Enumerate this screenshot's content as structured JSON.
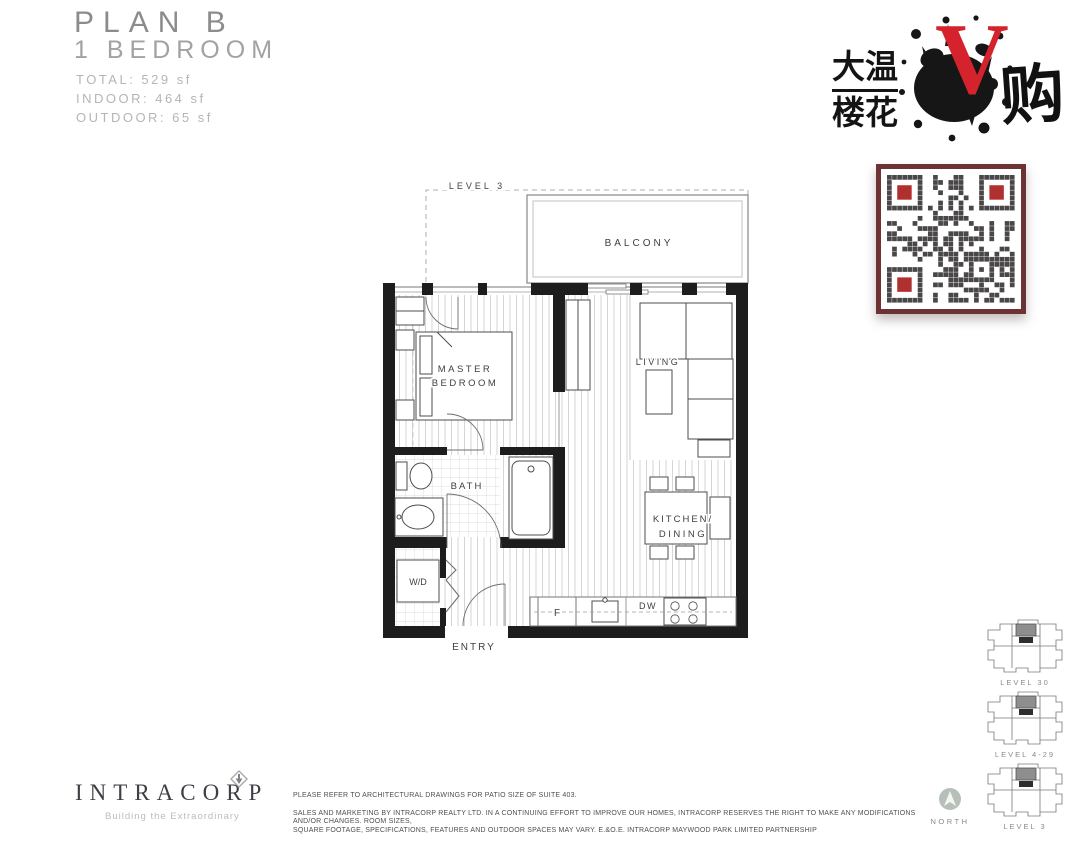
{
  "header": {
    "plan_name": "PLAN B",
    "plan_type": "1 BEDROOM",
    "stats": [
      "TOTAL: 529 sf",
      "INDOOR: 464 sf",
      "OUTDOOR: 65 sf"
    ]
  },
  "logo": {
    "cn_top": "大温",
    "cn_bottom": "楼花",
    "v_letter": "V",
    "cn_right": "购",
    "v_color": "#d5232e"
  },
  "qr": {
    "border_color": "#6d3334",
    "module_color": "#4a4748",
    "finder_color": "#b02f2f"
  },
  "floorplan": {
    "level_label": "LEVEL 3",
    "labels": {
      "balcony": "BALCONY",
      "master_line1": "MASTER",
      "master_line2": "BEDROOM",
      "living": "LIVING",
      "bath": "BATH",
      "kitchen_line1": "KITCHEN/",
      "kitchen_line2": "DINING",
      "wd": "W/D",
      "entry": "ENTRY",
      "fridge": "F",
      "dw": "DW"
    }
  },
  "keyplans": [
    {
      "label": "LEVEL 30"
    },
    {
      "label": "LEVEL 4-29"
    },
    {
      "label": "LEVEL 3"
    }
  ],
  "north_label": "NORTH",
  "footer": {
    "brand": "INTRACORP",
    "tagline": "Building the Extraordinary",
    "disclaimer1": "PLEASE REFER TO ARCHITECTURAL DRAWINGS FOR PATIO SIZE OF SUITE 403.",
    "disclaimer2": "SALES AND MARKETING BY INTRACORP REALTY LTD. IN A CONTINUING EFFORT TO IMPROVE OUR HOMES, INTRACORP RESERVES THE RIGHT TO MAKE ANY MODIFICATIONS AND/OR CHANGES. ROOM SIZES,",
    "disclaimer3": "SQUARE FOOTAGE, SPECIFICATIONS, FEATURES AND OUTDOOR SPACES MAY VARY. E.&O.E. INTRACORP MAYWOOD PARK LIMITED PARTNERSHIP"
  }
}
